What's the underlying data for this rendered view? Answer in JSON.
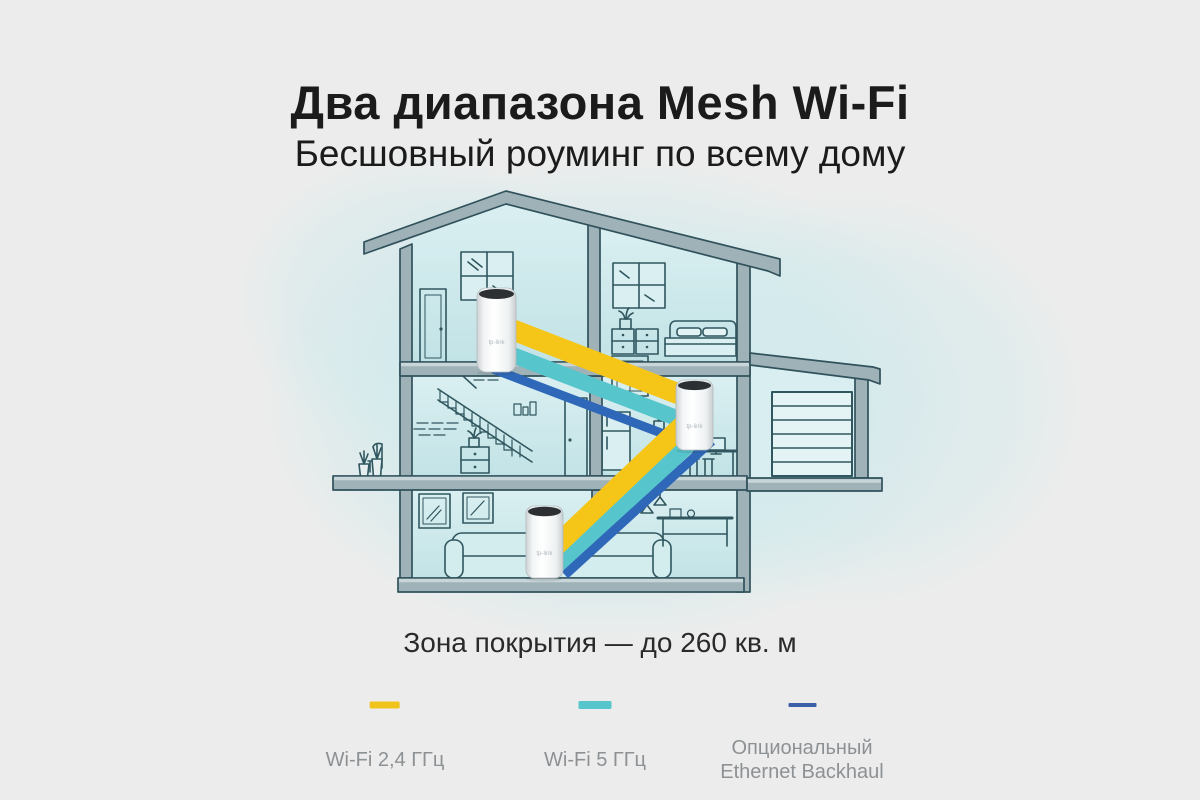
{
  "header": {
    "title": "Два диапазона Mesh Wi-Fi",
    "subtitle": "Бесшовный роуминг по всему дому"
  },
  "coverage": {
    "text": "Зона покрытия — до 260 кв. м"
  },
  "legend": {
    "items": [
      {
        "label": "Wi-Fi 2,4 ГГц",
        "color": "#f0c31d"
      },
      {
        "label": "Wi-Fi 5 ГГц",
        "color": "#57c5cc"
      },
      {
        "label": "Опциональный Ethernet Backhaul",
        "color": "#3a5fa8"
      }
    ]
  },
  "colors": {
    "wifi_24ghz_band": "#f5c518",
    "wifi_5ghz_band": "#57c5cc",
    "ethernet_band": "#2f68b8",
    "page_background": "#ececec"
  },
  "device": {
    "logo": "tp-link"
  }
}
